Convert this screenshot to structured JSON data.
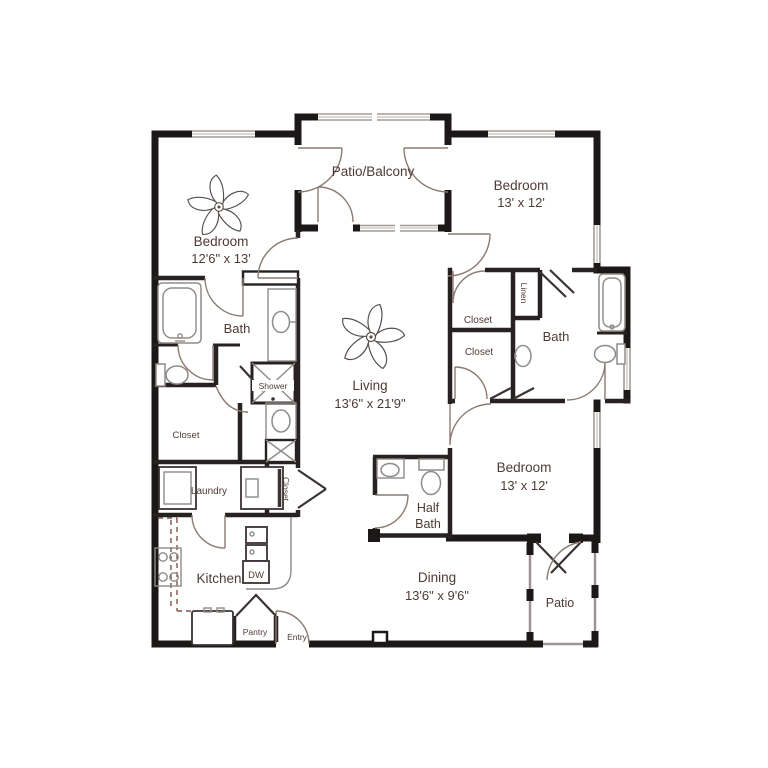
{
  "plan": {
    "type": "apartment-floor-plan",
    "colors": {
      "wall": "#1d1818",
      "text": "#4e3b35",
      "fixture": "#8f8b88",
      "door_arc": "#8d7a72",
      "window": "#a19b97",
      "counter_dash": "#7d564c"
    },
    "rooms": {
      "patio_balcony": {
        "name": "Patio/Balcony"
      },
      "bedroom1": {
        "name": "Bedroom",
        "dims": "12'6\" x 13'"
      },
      "bedroom2": {
        "name": "Bedroom",
        "dims": "13' x 12'"
      },
      "bedroom3": {
        "name": "Bedroom",
        "dims": "13' x 12'"
      },
      "living": {
        "name": "Living",
        "dims": "13'6\" x 21'9\""
      },
      "dining": {
        "name": "Dining",
        "dims": "13'6\" x 9'6\""
      },
      "kitchen": {
        "name": "Kitchen"
      },
      "bath_left": {
        "name": "Bath"
      },
      "bath_right": {
        "name": "Bath"
      },
      "half_bath": {
        "line1": "Half",
        "line2": "Bath"
      },
      "shower": {
        "name": "Shower"
      },
      "laundry": {
        "name": "Laundry"
      },
      "closet_left": {
        "name": "Closet"
      },
      "closet_hall": {
        "name": "Closet"
      },
      "closet_right_upper": {
        "name": "Closet"
      },
      "closet_right_lower": {
        "name": "Closet"
      },
      "linen": {
        "name": "Linen"
      },
      "pantry": {
        "name": "Pantry"
      },
      "entry": {
        "name": "Entry"
      },
      "patio": {
        "name": "Patio"
      }
    },
    "appliances": {
      "dishwasher": "DW"
    }
  }
}
